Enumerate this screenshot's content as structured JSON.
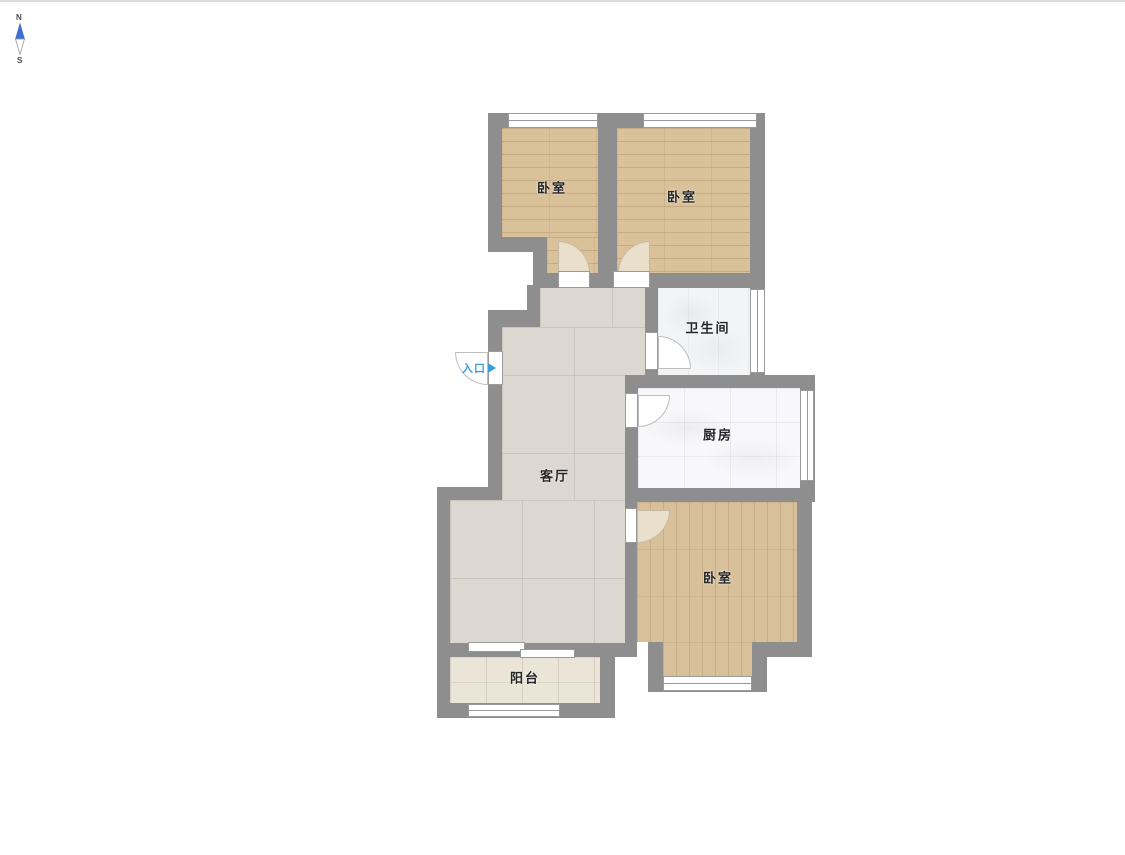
{
  "compass": {
    "north": "N",
    "south": "S"
  },
  "entrance": {
    "label": "入口"
  },
  "rooms": {
    "bedroom_top_left": {
      "label": "卧室"
    },
    "bedroom_top_right": {
      "label": "卧室"
    },
    "bathroom": {
      "label": "卫生间"
    },
    "kitchen": {
      "label": "厨房"
    },
    "living_room": {
      "label": "客厅"
    },
    "bedroom_bottom": {
      "label": "卧室"
    },
    "balcony": {
      "label": "阳台"
    }
  },
  "colors": {
    "wall": "#8e8e8e",
    "wood_floor": "#d9c19a",
    "tile_floor": "#dcd8d1",
    "balcony_floor": "#ebe5d8",
    "kitchen_floor": "#f8f8fa",
    "bathroom_floor": "#f3f4f6",
    "door_swing": "#eadfcb",
    "entrance_accent": "#3d9be0",
    "compass_blue": "#3c6fd3"
  }
}
